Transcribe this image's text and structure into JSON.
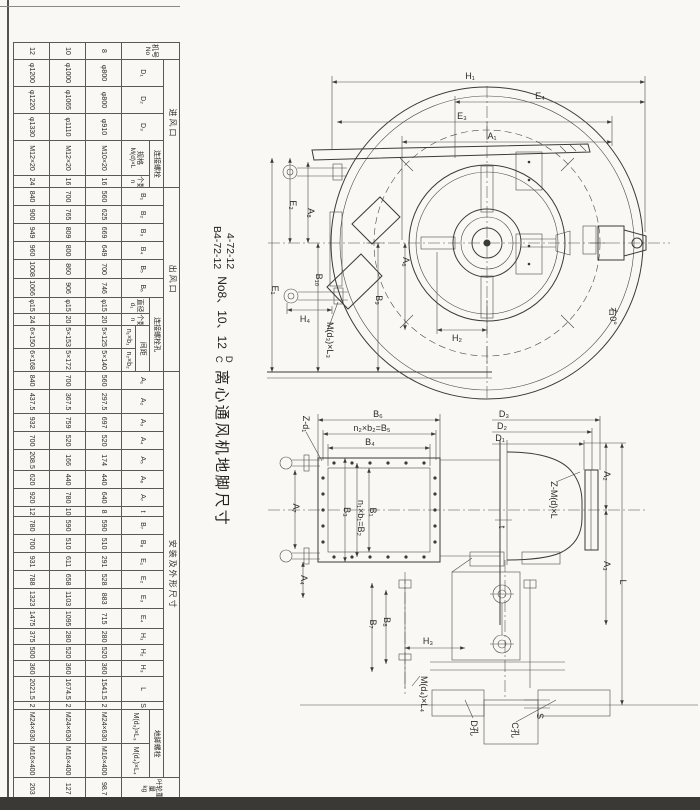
{
  "colors": {
    "ink": "#3a3a36",
    "paper": "#f9f8f5",
    "scan_band": "#3a3936"
  },
  "title": {
    "model_a": "4-72-12",
    "model_b": "B4-72-12",
    "size_range": "No8、10、12",
    "variant_a": "D",
    "variant_b": "C",
    "subject": "离心通风机地脚尺寸"
  },
  "table": {
    "group_headers": {
      "machine": "机号",
      "machine_sub": "No",
      "inlet": "进风口",
      "outlet": "出风口",
      "install": "安装及外形尺寸",
      "conn_bolt": "连接螺栓",
      "conn_bolt_hole": "连接螺栓孔",
      "spacing": "间距",
      "anchor_bolt": "地脚螺栓",
      "spec": "规格",
      "spec_sym": "M(d)×L",
      "count": "个数",
      "count_sym": "n",
      "dia": "直径",
      "dia_sym": "d₁",
      "impeller_wt": "叶轮重量",
      "impeller_wt_unit": "kg",
      "fan_wt": "风机重量(不含电机)",
      "fan_wt_unit": "kg"
    },
    "col_headers": {
      "d1": "D₁",
      "d2": "D₂",
      "d3": "D₃",
      "b1": "B₁",
      "b2": "B₂",
      "b3": "B₃",
      "b4": "B₄",
      "b5": "B₅",
      "b6": "B₆",
      "n1b1": "n₁×b₁",
      "n2b2": "n₂×b₂",
      "a1": "A₁",
      "a2": "A₂",
      "a3": "A₃",
      "a4": "A₄",
      "a5": "A₅",
      "a6": "A₆",
      "a7": "A₇",
      "t": "t",
      "b7": "B₇",
      "b8": "B₈",
      "e1": "E₁",
      "e2": "E₂",
      "e3": "E₃",
      "e4": "E₄",
      "h1": "H₁",
      "h2": "H₂",
      "h3": "H₃",
      "l": "L",
      "s": "S",
      "fb1": "M(d₃)×L₃",
      "fb2": "M(d₄)×L₄"
    },
    "col_order": [
      "no",
      "d1",
      "d2",
      "d3",
      "bolt_spec",
      "bolt_n",
      "b1",
      "b2",
      "b3",
      "b4",
      "b5",
      "b6",
      "hole_d",
      "hole_n",
      "n1b1",
      "n2b2",
      "a1",
      "a2",
      "a3",
      "a4",
      "a5",
      "a6",
      "a7",
      "t",
      "b7",
      "b8",
      "e1",
      "e2",
      "e3",
      "e4",
      "h1",
      "h2",
      "h3",
      "l",
      "s",
      "fb1",
      "fb2",
      "impeller_wt",
      "fan_wt"
    ],
    "rows": [
      {
        "no": "8",
        "d1": "φ800",
        "d2": "φ800",
        "d3": "φ910",
        "bolt_spec": "M10×20",
        "bolt_n": "16",
        "b1": "560",
        "b2": "625",
        "b3": "669",
        "b4": "649",
        "b5": "700",
        "b6": "746",
        "hole_d": "φ15",
        "hole_n": "20",
        "n1b1": "5×125",
        "n2b2": "5×140",
        "a1": "560",
        "a2": "297.5",
        "a3": "697",
        "a4": "520",
        "a5": "174",
        "a6": "440",
        "a7": "640",
        "t": "8",
        "b7": "590",
        "b8": "510",
        "e1": "291",
        "e2": "528",
        "e3": "883",
        "e4": "715",
        "h1": "280",
        "h2": "520",
        "h3": "360",
        "l": "1541.5",
        "s": "2",
        "fb1": "M24×630",
        "fb2": "M16×400",
        "impeller_wt": "98.7",
        "fan_wt": "609"
      },
      {
        "no": "10",
        "d1": "φ1000",
        "d2": "φ1065",
        "d3": "φ1110",
        "bolt_spec": "M12×20",
        "bolt_n": "16",
        "b1": "700",
        "b2": "765",
        "b3": "809",
        "b4": "800",
        "b5": "860",
        "b6": "906",
        "hole_d": "φ15",
        "hole_n": "20",
        "n1b1": "5×153",
        "n2b2": "5×172",
        "a1": "700",
        "a2": "367.5",
        "a3": "759",
        "a4": "520",
        "a5": "166",
        "a6": "440",
        "a7": "780",
        "t": "10",
        "b7": "590",
        "b8": "510",
        "e1": "611",
        "e2": "658",
        "e3": "1103",
        "e4": "1095",
        "h1": "280",
        "h2": "520",
        "h3": "360",
        "l": "1674.5",
        "s": "2",
        "fb1": "M24×630",
        "fb2": "M16×400",
        "impeller_wt": "127",
        "fan_wt": "817"
      },
      {
        "no": "12",
        "d1": "φ1200",
        "d2": "φ1220",
        "d3": "φ1330",
        "bolt_spec": "M12×20",
        "bolt_n": "24",
        "b1": "840",
        "b2": "900",
        "b3": "949",
        "b4": "960",
        "b5": "1008",
        "b6": "1066",
        "hole_d": "φ15",
        "hole_n": "24",
        "n1b1": "6×150",
        "n2b2": "6×168",
        "a1": "840",
        "a2": "437.5",
        "a3": "932",
        "a4": "700",
        "a5": "208.5",
        "a6": "620",
        "a7": "920",
        "t": "12",
        "b7": "780",
        "b8": "700",
        "e1": "931",
        "e2": "788",
        "e3": "1323",
        "e4": "1475",
        "h1": "375",
        "h2": "500",
        "h3": "360",
        "l": "2021.5",
        "s": "2",
        "fb1": "M24×630",
        "fb2": "M16×400",
        "impeller_wt": "203",
        "fan_wt": "1244"
      }
    ]
  },
  "front_view": {
    "labels": {
      "h1": "H₁",
      "e4": "E₄",
      "e3": "E₃",
      "a1": "A₁",
      "e1": "E₁",
      "e2": "E₂",
      "a8": "A₈",
      "b10": "B₁₀",
      "b9": "B₉",
      "a6": "A₆",
      "h4": "H₄",
      "h2": "H₂",
      "md3l3": "M(d₃)×L₃",
      "rotation": "右0°"
    }
  },
  "side_view": {
    "labels": {
      "b6": "B₆",
      "b5eq": "n₂×b₂=B₅",
      "b4": "B₄",
      "zd1": "Z-d₁",
      "a7": "A₇",
      "a4": "A₄",
      "b3": "B₃",
      "b2eq": "n₁×b₁=B₂",
      "b1": "B₁",
      "d3": "D₃",
      "d2": "D₂",
      "d1": "D₁",
      "zmdl": "Z-M(d)×L",
      "t": "t",
      "a2": "A₂",
      "a3": "A₃",
      "l": "L",
      "s": "S",
      "b7": "B₇",
      "b8": "B₈",
      "h3": "H₃",
      "md4l4": "M(d₄)×L₄",
      "dk": "D孔",
      "ck": "C孔"
    }
  }
}
